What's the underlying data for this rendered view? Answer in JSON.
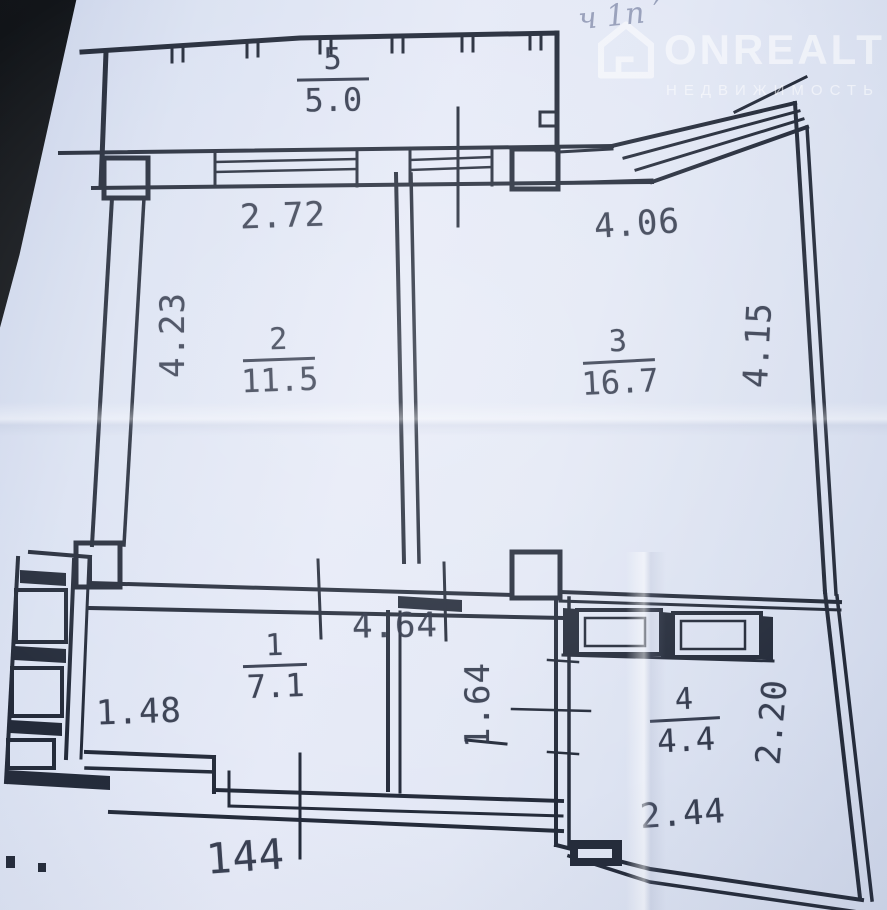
{
  "photo": {
    "handwriting": "ч 1п ′",
    "watermark": {
      "brand": "ONREALT",
      "subtitle": "НЕДВИЖИМОСТЬ",
      "icon": "house-icon",
      "color": "#ffffff"
    }
  },
  "plan": {
    "line_color": "#242b3a",
    "paper_color": "#dfe5f3",
    "rooms": {
      "r5": {
        "number": "5",
        "area": "5.0"
      },
      "r2": {
        "number": "2",
        "area": "11.5"
      },
      "r3": {
        "number": "3",
        "area": "16.7"
      },
      "r1": {
        "number": "1",
        "area": "7.1"
      },
      "r4": {
        "number": "4",
        "area": "4.4"
      }
    },
    "dims": {
      "d272": "2.72",
      "d406": "4.06",
      "d423": "4.23",
      "d415": "4.15",
      "d464": "4.64",
      "d148": "1.48",
      "d164": "1.64",
      "d220": "2.20",
      "d244": "2.44",
      "d144": "144"
    }
  }
}
